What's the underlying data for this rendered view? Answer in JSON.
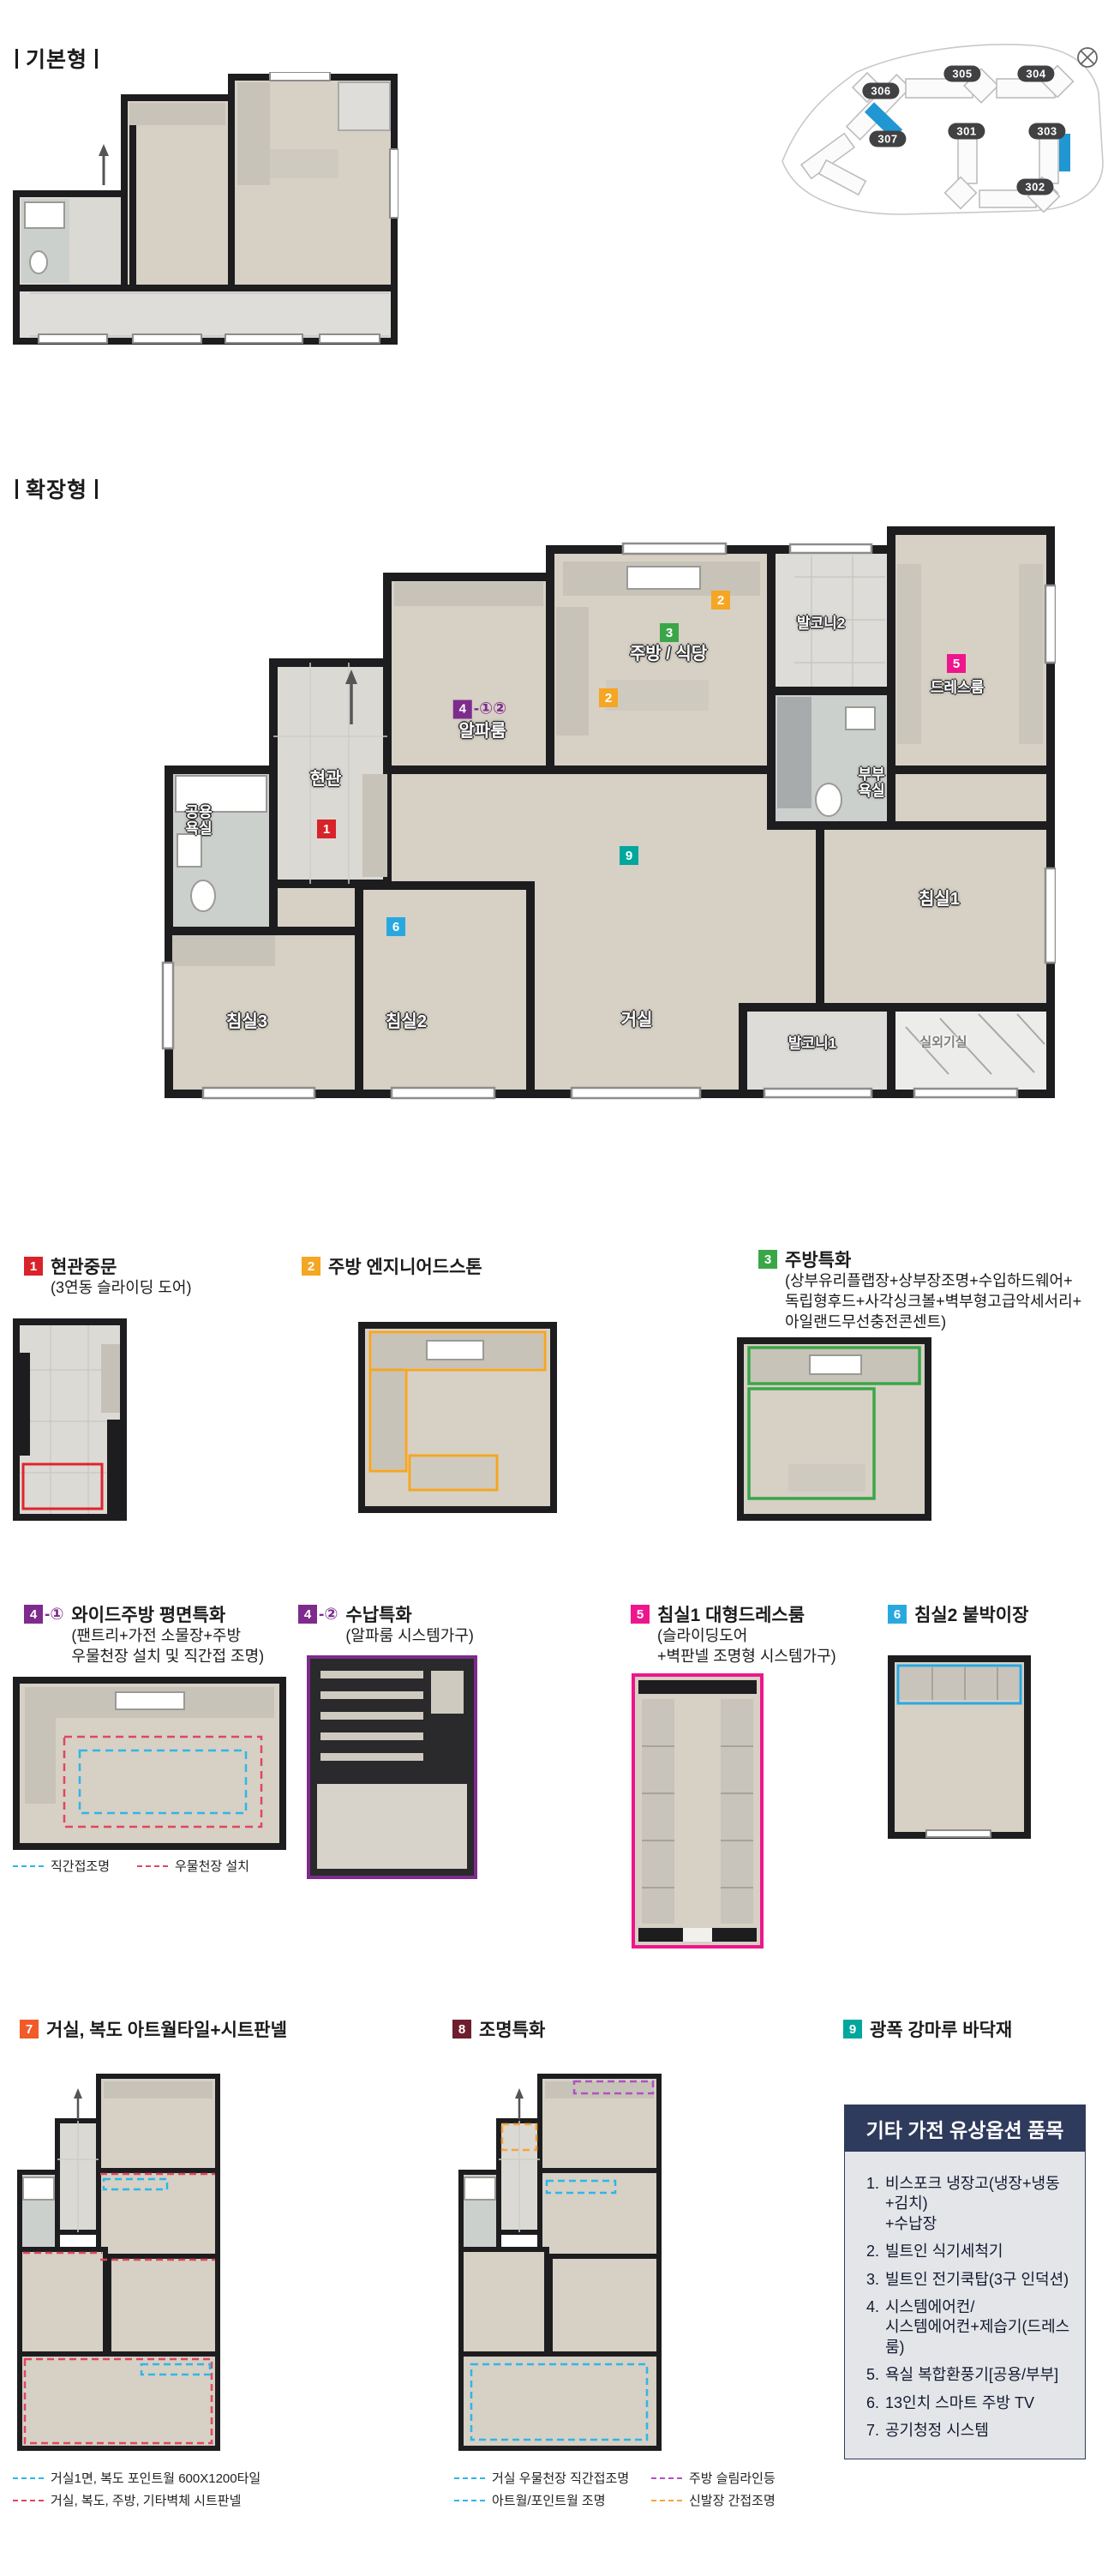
{
  "colors": {
    "badge_red": "#d8232a",
    "badge_orange": "#f5a623",
    "badge_green": "#3aa648",
    "badge_purple": "#7d2b8d",
    "badge_pink": "#ee168c",
    "badge_blue": "#29a8e0",
    "badge_orange_red": "#f15a29",
    "badge_maroon": "#6e1e2e",
    "badge_teal": "#00a79d",
    "site_highlight": "#2097d3",
    "options_header_bg": "#2f3b5c",
    "legend_cyan": "#2fb6e8",
    "legend_red": "#e0475f",
    "legend_purple": "#b052c0",
    "legend_orange": "#f5a53c"
  },
  "sections": {
    "basic": {
      "label": "기본형"
    },
    "extended": {
      "label": "확장형"
    }
  },
  "site_map": {
    "buildings": [
      {
        "label": "306"
      },
      {
        "label": "305"
      },
      {
        "label": "304"
      },
      {
        "label": "307"
      },
      {
        "label": "301"
      },
      {
        "label": "303"
      },
      {
        "label": "302"
      }
    ]
  },
  "plan": {
    "rooms": {
      "entry": "현관",
      "common_bath_1": "공용",
      "common_bath_2": "욕실",
      "alpha_room": "알파룸",
      "kitchen": "주방 / 식당",
      "balcony2": "발코니2",
      "dress_room": "드레스룸",
      "master_bath_1": "부부",
      "master_bath_2": "욕실",
      "bedroom1": "침실1",
      "bedroom2": "침실2",
      "bedroom3": "침실3",
      "living": "거실",
      "balcony1": "발코니1",
      "ac_room": "실외기실"
    },
    "badges": {
      "b1": "1",
      "b2": "2",
      "b3": "3",
      "b4": "4",
      "b4sfx": "-①②",
      "b5": "5",
      "b6": "6",
      "b9": "9"
    }
  },
  "features": {
    "f1": {
      "num": "1",
      "title": "현관중문",
      "sub1": "(3연동 슬라이딩 도어)"
    },
    "f2": {
      "num": "2",
      "title": "주방 엔지니어드스톤"
    },
    "f3": {
      "num": "3",
      "title": "주방특화",
      "sub1": "(상부유리플랩장+상부장조명+수입하드웨어+",
      "sub2": "독립형후드+사각싱크볼+벽부형고급악세서리+",
      "sub3": "아일랜드무선충전콘센트)"
    },
    "f4_1": {
      "num": "4",
      "suffix": "-①",
      "title": "와이드주방 평면특화",
      "sub1": "(팬트리+가전 소물장+주방",
      "sub2": "우물천장 설치 및 직간접 조명)"
    },
    "f4_2": {
      "num": "4",
      "suffix": "-②",
      "title": "수납특화",
      "sub1": "(알파룸 시스템가구)"
    },
    "f5": {
      "num": "5",
      "title": "침실1 대형드레스룸",
      "sub1": "(슬라이딩도어",
      "sub2": "+벽판넬 조명형 시스템가구)"
    },
    "f6": {
      "num": "6",
      "title": "침실2 붙박이장"
    },
    "f7": {
      "num": "7",
      "title": "거실, 복도 아트월타일+시트판넬"
    },
    "f8": {
      "num": "8",
      "title": "조명특화"
    },
    "f9": {
      "num": "9",
      "title": "광폭 강마루 바닥재"
    }
  },
  "legends": {
    "f4_1a": "직간접조명",
    "f4_1b": "우물천장 설치",
    "f7a": "거실1면, 복도 포인트월 600X1200타일",
    "f7b": "거실, 복도, 주방, 기타벽체 시트판넬",
    "f8a": "거실 우물천장 직간접조명",
    "f8b": "주방 슬림라인등",
    "f8c": "아트월/포인트월 조명",
    "f8d": "신발장 간접조명"
  },
  "options_box": {
    "title": "기타 가전 유상옵션 품목",
    "items": [
      {
        "num": "1.",
        "l1": "비스포크 냉장고(냉장+냉동+김치)",
        "l2": "+수납장"
      },
      {
        "num": "2.",
        "l1": "빌트인 식기세척기"
      },
      {
        "num": "3.",
        "l1": "빌트인 전기쿡탑(3구 인덕션)"
      },
      {
        "num": "4.",
        "l1": "시스템에어컨/",
        "l2": "시스템에어컨+제습기(드레스룸)"
      },
      {
        "num": "5.",
        "l1": "욕실 복합환풍기[공용/부부]"
      },
      {
        "num": "6.",
        "l1": "13인치 스마트 주방 TV"
      },
      {
        "num": "7.",
        "l1": "공기청정 시스템"
      }
    ]
  }
}
